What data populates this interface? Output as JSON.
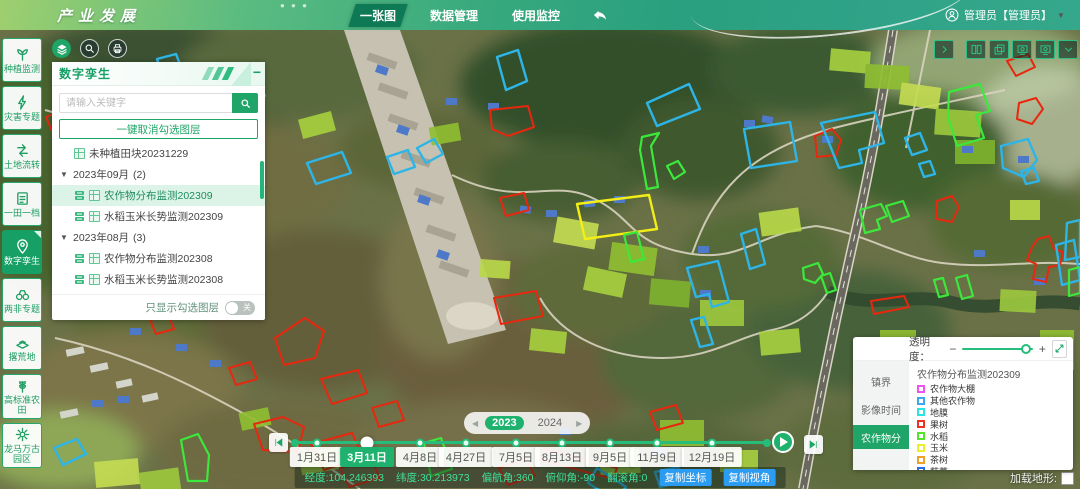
{
  "header": {
    "logo": "产业发展",
    "nav": [
      {
        "label": "一张图",
        "active": true
      },
      {
        "label": "数据管理",
        "active": false
      },
      {
        "label": "使用监控",
        "active": false
      }
    ],
    "user": {
      "name": "管理员【管理员】",
      "dropdown_icon": "▼"
    }
  },
  "sidebar": {
    "items": [
      {
        "label": "种植监测",
        "icon": "sprout-icon",
        "active": false
      },
      {
        "label": "灾害专题",
        "icon": "disaster-icon",
        "active": false
      },
      {
        "label": "土地流转",
        "icon": "land-transfer-icon",
        "active": false
      },
      {
        "label": "一田一档",
        "icon": "field-archive-icon",
        "active": false
      },
      {
        "label": "数字孪生",
        "icon": "location-pin-icon",
        "active": true
      },
      {
        "label": "两非专题",
        "icon": "binoculars-icon",
        "active": false
      },
      {
        "label": "撂荒地",
        "icon": "fallow-land-icon",
        "active": false
      },
      {
        "label": "高标准农田",
        "icon": "wheat-icon",
        "active": false
      },
      {
        "label": "龙马万古园区",
        "icon": "park-icon",
        "active": false
      }
    ]
  },
  "layer_panel": {
    "title": "数字孪生",
    "minimize_icon": "−",
    "search": {
      "placeholder": "请输入关键字"
    },
    "uncheck_all_button": "一键取消勾选图层",
    "tree": [
      {
        "type": "leaf",
        "label": "未种植田块20231229"
      },
      {
        "type": "group",
        "label": "2023年09月",
        "count": "(2)",
        "children": [
          {
            "label": "农作物分布监测202309",
            "selected": true
          },
          {
            "label": "水稻玉米长势监测202309",
            "selected": false
          }
        ]
      },
      {
        "type": "group",
        "label": "2023年08月",
        "count": "(3)",
        "children": [
          {
            "label": "农作物分布监测202308",
            "selected": false
          },
          {
            "label": "水稻玉米长势监测202308",
            "selected": false
          }
        ]
      }
    ],
    "show_checked_only": {
      "label": "只显示勾选图层",
      "state": "关"
    }
  },
  "timeline": {
    "year_selector": {
      "prev": "◀",
      "next": "▶",
      "years": [
        {
          "label": "2023",
          "active": true
        },
        {
          "label": "2024",
          "active": false
        }
      ]
    },
    "dates": [
      {
        "label": "1月31日",
        "active": false
      },
      {
        "label": "3月11日",
        "active": true
      },
      {
        "label": "4月8日",
        "active": false
      },
      {
        "label": "4月27日",
        "active": false
      },
      {
        "label": "7月5日",
        "active": false
      },
      {
        "label": "8月13日",
        "active": false
      },
      {
        "label": "9月5日",
        "active": false
      },
      {
        "label": "11月9日",
        "active": false
      },
      {
        "label": "12月19日",
        "active": false
      }
    ]
  },
  "status_bar": {
    "coordinates": [
      "经度:104.246393",
      "纬度:30.213973",
      "偏航角:360",
      "俯仰角:-90",
      "翻滚角:0"
    ],
    "copy_buttons": [
      "复制坐标",
      "复制视角"
    ]
  },
  "legend_panel": {
    "opacity": {
      "label": "透明度：",
      "minus": "−",
      "plus": "+",
      "value_percent": 85
    },
    "tabs": [
      {
        "label": "镇界",
        "active": false
      },
      {
        "label": "影像时间",
        "active": false
      },
      {
        "label": "农作物分",
        "active": true
      }
    ],
    "layer_title": "农作物分布监测202309",
    "items": [
      {
        "label": "农作物大棚",
        "color": "#ee55ee"
      },
      {
        "label": "其他农作物",
        "color": "#3aa8f0"
      },
      {
        "label": "地膜",
        "color": "#2ae4e4"
      },
      {
        "label": "果树",
        "color": "#f03022"
      },
      {
        "label": "水稻",
        "color": "#55e52e"
      },
      {
        "label": "玉米",
        "color": "#eeee2a"
      },
      {
        "label": "茶树",
        "color": "#f0a028"
      },
      {
        "label": "蔬菜",
        "color": "#2a6cf0"
      }
    ]
  },
  "terrain_toggle": {
    "label": "加载地形:"
  }
}
